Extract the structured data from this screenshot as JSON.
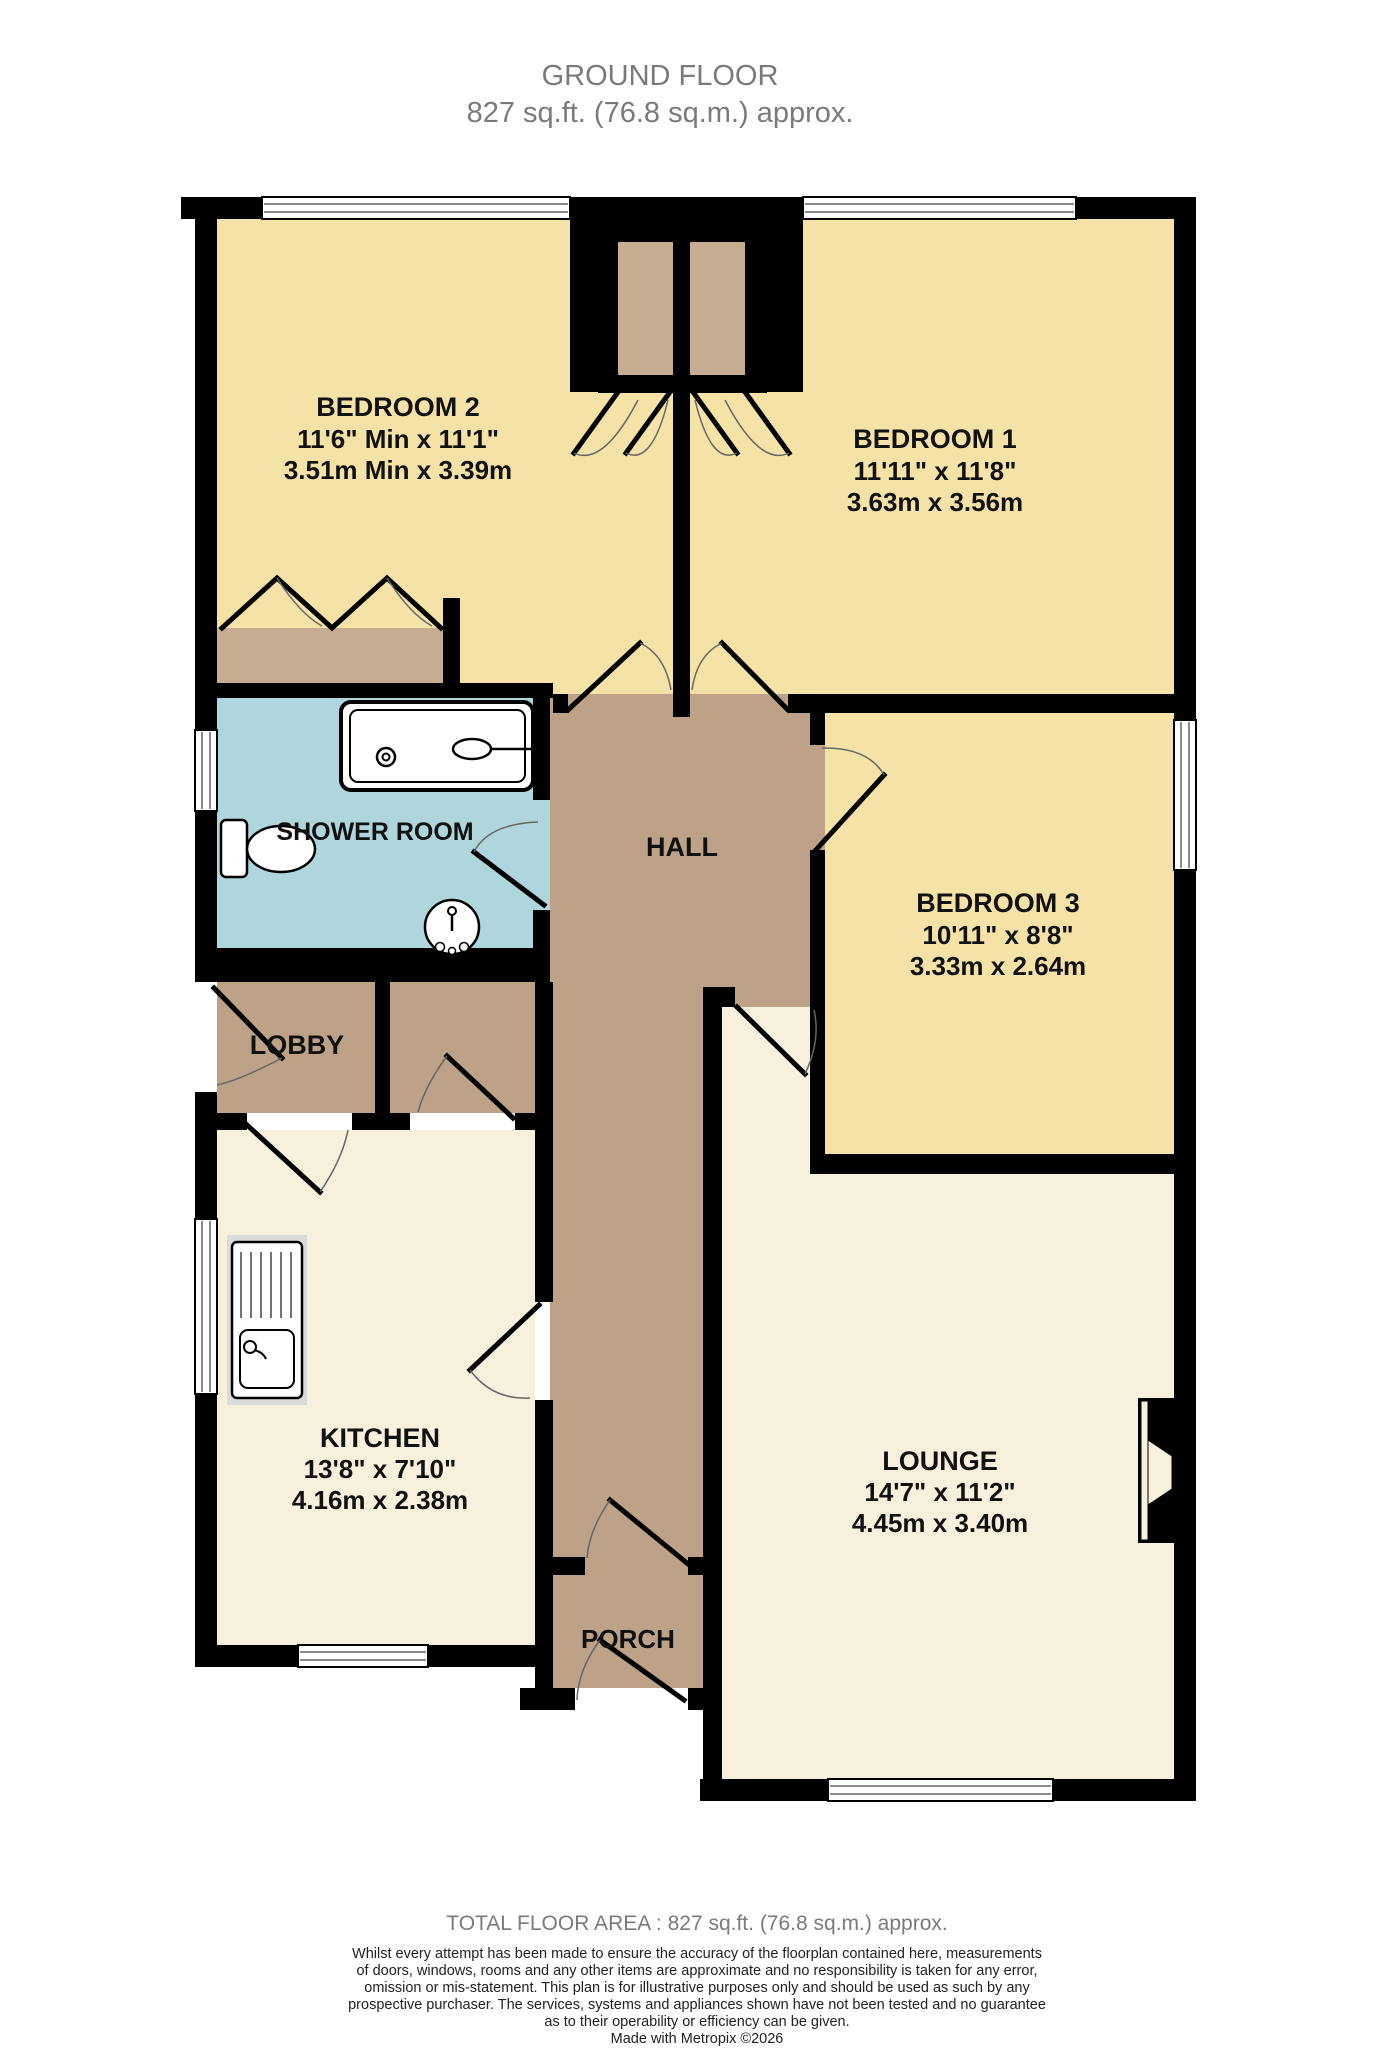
{
  "title": {
    "line1": "GROUND FLOOR",
    "line2": "827 sq.ft. (76.8 sq.m.) approx."
  },
  "rooms": {
    "bedroom2": {
      "name": "BEDROOM 2",
      "size_imperial": "11'6\" Min x 11'1\"",
      "size_metric": "3.51m Min x 3.39m"
    },
    "bedroom1": {
      "name": "BEDROOM 1",
      "size_imperial": "11'11\"  x 11'8\"",
      "size_metric": "3.63m  x 3.56m"
    },
    "bedroom3": {
      "name": "BEDROOM 3",
      "size_imperial": "10'11\"  x 8'8\"",
      "size_metric": "3.33m  x 2.64m"
    },
    "shower_room": {
      "name": "SHOWER ROOM"
    },
    "hall": {
      "name": "HALL"
    },
    "lobby": {
      "name": "LOBBY"
    },
    "kitchen": {
      "name": "KITCHEN",
      "size_imperial": "13'8\"  x 7'10\"",
      "size_metric": "4.16m  x 2.38m"
    },
    "lounge": {
      "name": "LOUNGE",
      "size_imperial": "14'7\"  x 11'2\"",
      "size_metric": "4.45m  x 3.40m"
    },
    "porch": {
      "name": "PORCH"
    }
  },
  "footer": {
    "total_area": "TOTAL FLOOR AREA : 827 sq.ft. (76.8 sq.m.) approx.",
    "disclaimer_lines": [
      "Whilst every attempt has been made to ensure the accuracy of the floorplan contained here, measurements",
      "of doors, windows, rooms and any other items are approximate and no responsibility is taken for any error,",
      "omission or mis-statement. This plan is for illustrative purposes only and should be used as such by any",
      "prospective purchaser. The services, systems and appliances shown have not been tested and no guarantee",
      "as to their operability or efficiency can be given."
    ],
    "credit": "Made with Metropix ©2026"
  },
  "colors": {
    "bedroom": "#F4E2A6",
    "circulation": "#BDA287",
    "closet": "#C6AC90",
    "shower": "#AFD6DD",
    "cream": "#F7F0DC",
    "wall": "#000000",
    "counter": "#DBDBDB",
    "title_gray": "#7A7A7A"
  }
}
